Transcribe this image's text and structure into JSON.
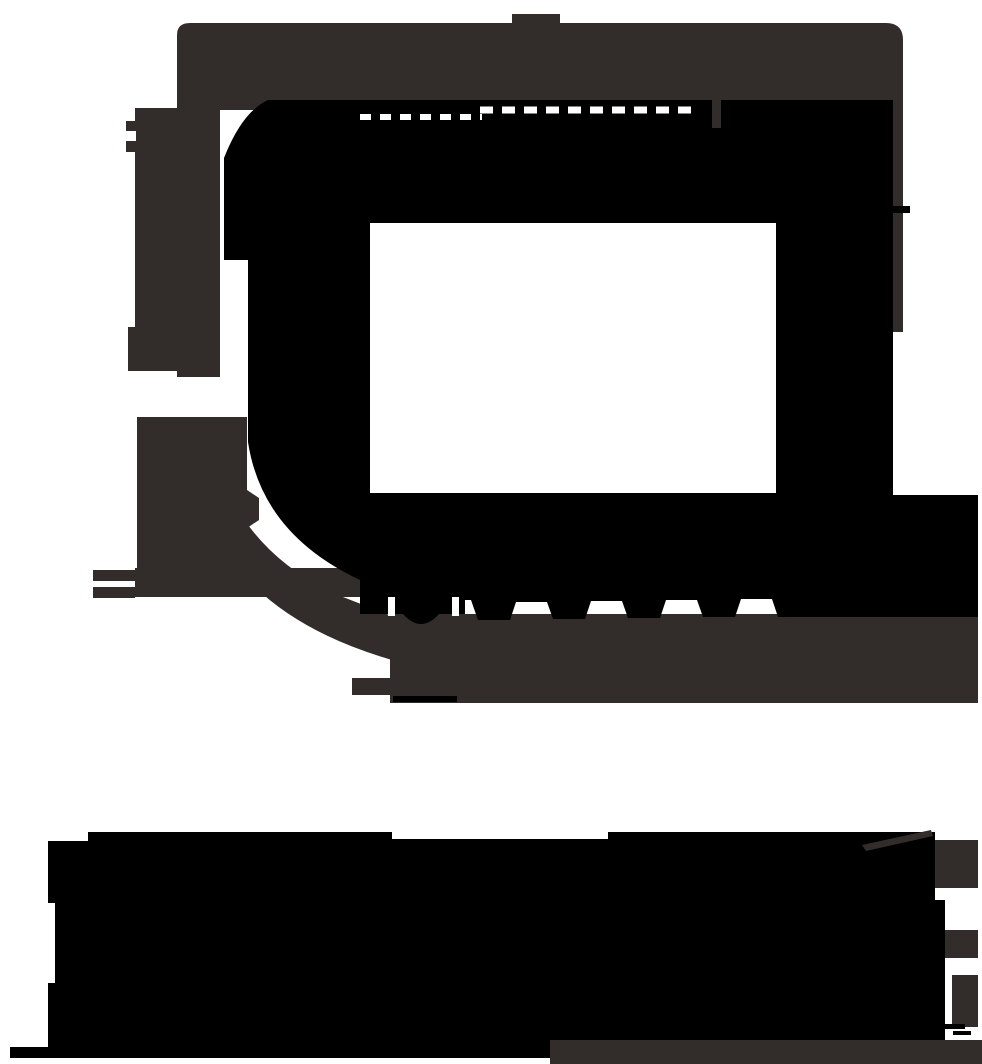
{
  "canvas": {
    "width": 982,
    "height": 1064,
    "background": "#FFFFFF"
  },
  "palette": {
    "black": "#000000",
    "charcoal": "#322D2B",
    "white": "#FFFFFF"
  },
  "artwork": {
    "name": "monochrome-silhouette",
    "shapes": [
      {
        "name": "top-tab",
        "type": "rect",
        "x": 512,
        "y": 14,
        "w": 48,
        "h": 10,
        "fill": "charcoal"
      },
      {
        "name": "head-band",
        "type": "path",
        "d": "M 190,23 H 886 Q 903,23 903,40 V 332 H 893 V 110 H 177 V 35 Q 177,23 190,23 Z",
        "fill": "charcoal"
      },
      {
        "name": "left-column-upper",
        "type": "rect",
        "x": 135,
        "y": 108,
        "w": 85,
        "h": 225,
        "fill": "charcoal"
      },
      {
        "name": "left-column-connector",
        "type": "rect",
        "x": 177,
        "y": 333,
        "w": 43,
        "h": 44,
        "fill": "charcoal"
      },
      {
        "name": "left-knob",
        "type": "rect",
        "x": 128,
        "y": 327,
        "w": 50,
        "h": 44,
        "fill": "charcoal"
      },
      {
        "name": "left-tab",
        "type": "rect",
        "x": 126,
        "y": 121,
        "w": 52,
        "h": 31,
        "fill": "charcoal"
      },
      {
        "name": "left-panel",
        "type": "rect",
        "x": 137,
        "y": 417,
        "w": 110,
        "h": 163,
        "fill": "charcoal"
      },
      {
        "name": "left-panel-point",
        "type": "polygon",
        "points": "247,490 259,498 259,520 247,528",
        "fill": "charcoal"
      },
      {
        "name": "left-bar",
        "type": "rect",
        "x": 135,
        "y": 568,
        "w": 226,
        "h": 29,
        "fill": "charcoal"
      },
      {
        "name": "bar-end-mark-top",
        "type": "rect",
        "x": 93,
        "y": 570,
        "w": 42,
        "h": 11,
        "fill": "charcoal"
      },
      {
        "name": "bar-end-mark-bottom",
        "type": "rect",
        "x": 93,
        "y": 587,
        "w": 42,
        "h": 11,
        "fill": "charcoal"
      },
      {
        "name": "head-bottom-curve",
        "type": "path",
        "d": "M 213,437 Q 228,540 330,592 L 392,616 L 392,660 Q 282,628 233,562 Q 206,495 206,440 Z",
        "fill": "charcoal"
      },
      {
        "name": "chin-band",
        "type": "rect",
        "x": 390,
        "y": 614,
        "w": 588,
        "h": 89,
        "fill": "charcoal"
      },
      {
        "name": "stand-foot",
        "type": "rect",
        "x": 352,
        "y": 678,
        "w": 40,
        "h": 17,
        "fill": "charcoal"
      },
      {
        "name": "head-silhouette",
        "type": "path",
        "fillRule": "evenodd",
        "d": "M 268,100 H 893 V 495 H 978 V 617 H 778 L 772,599 H 741 L 735,617 H 703 L 697,600 H 666 L 660,618 H 628 L 622,601 H 591 L 585,619 H 553 L 547,602 H 516 L 510,620 H 478 L 471,600 H 465 V 614 H 360 V 580 Q 262,534 248,442 V 260 H 224 V 158 Q 242,112 268,100 Z M 370,223 H 776 V 493 H 370 Z",
        "fill": "black"
      },
      {
        "name": "screen",
        "type": "rect",
        "x": 370,
        "y": 223,
        "w": 406,
        "h": 270,
        "fill": "white"
      },
      {
        "name": "stand-bump",
        "type": "path",
        "d": "M 403,614 Q 421,634 439,614 Z",
        "fill": "black"
      },
      {
        "name": "stand-base-line",
        "type": "rect",
        "x": 393,
        "y": 696,
        "w": 64,
        "h": 6,
        "fill": "black"
      },
      {
        "name": "right-edge-tick",
        "type": "rect",
        "x": 893,
        "y": 206,
        "w": 17,
        "h": 7,
        "fill": "black"
      },
      {
        "name": "base-slab",
        "type": "path",
        "d": "M 88,832 H 392 V 839 H 608 V 832 H 935 V 900 H 945 V 1040 H 552 V 1047 H 48 V 983 H 55 V 903 H 48 V 841 H 88 Z",
        "fill": "black"
      },
      {
        "name": "base-ledge",
        "type": "rect",
        "x": 10,
        "y": 1047,
        "w": 542,
        "h": 11,
        "fill": "black"
      },
      {
        "name": "base-bottom-strip",
        "type": "rect",
        "x": 550,
        "y": 1040,
        "w": 432,
        "h": 24,
        "fill": "charcoal"
      },
      {
        "name": "base-corner-piece",
        "type": "rect",
        "x": 935,
        "y": 840,
        "w": 43,
        "h": 48,
        "fill": "charcoal"
      },
      {
        "name": "base-side-piece",
        "type": "rect",
        "x": 945,
        "y": 930,
        "w": 33,
        "h": 28,
        "fill": "charcoal"
      },
      {
        "name": "base-side-bar",
        "type": "rect",
        "x": 952,
        "y": 975,
        "w": 26,
        "h": 52,
        "fill": "charcoal"
      },
      {
        "name": "base-diagonal-stroke",
        "type": "polygon",
        "points": "862,845 931,830 933,836 866,851",
        "fill": "charcoal"
      },
      {
        "name": "screen-slit",
        "type": "rect",
        "x": 712,
        "y": 95,
        "w": 9,
        "h": 33,
        "fill": "charcoal"
      },
      {
        "name": "corner-mark-a",
        "type": "rect",
        "x": 945,
        "y": 1024,
        "w": 20,
        "h": 5,
        "fill": "black"
      },
      {
        "name": "corner-mark-b",
        "type": "rect",
        "x": 953,
        "y": 1031,
        "w": 18,
        "h": 4,
        "fill": "black"
      },
      {
        "name": "tab-notch",
        "type": "rect",
        "x": 124,
        "y": 131,
        "w": 12,
        "h": 10,
        "fill": "white"
      },
      {
        "name": "band-dash-line-right",
        "type": "line",
        "x1": 480,
        "y1": 110,
        "x2": 700,
        "y2": 110,
        "stroke": "white",
        "strokeWidth": 7,
        "dash": "13 9"
      },
      {
        "name": "band-dash-line-left",
        "type": "line",
        "x1": 360,
        "y1": 117,
        "x2": 482,
        "y2": 117,
        "stroke": "white",
        "strokeWidth": 6,
        "dash": "11 9"
      },
      {
        "name": "stand-slit-left",
        "type": "rect",
        "x": 388,
        "y": 597,
        "w": 7,
        "h": 19,
        "fill": "white"
      },
      {
        "name": "stand-slit-right",
        "type": "rect",
        "x": 452,
        "y": 597,
        "w": 7,
        "h": 19,
        "fill": "white"
      }
    ]
  }
}
